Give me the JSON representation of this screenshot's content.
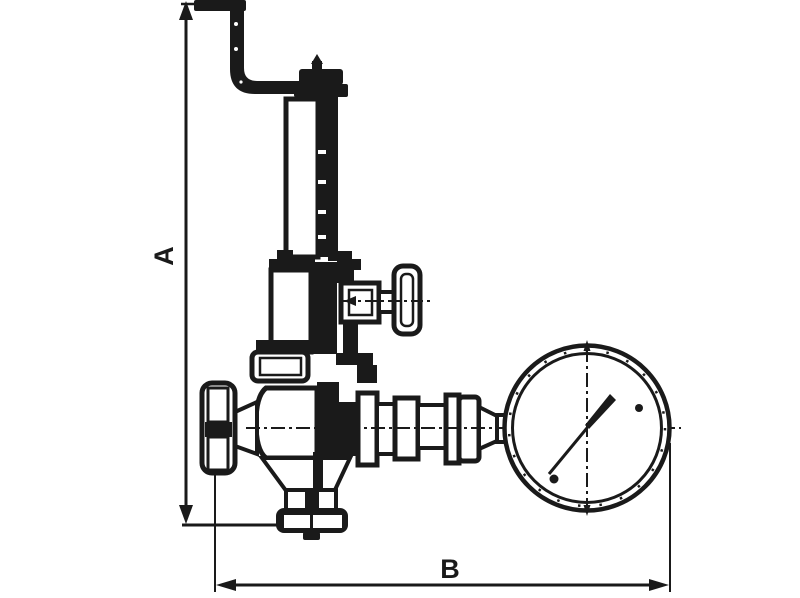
{
  "drawing": {
    "type": "technical-dimensional-drawing",
    "subject": "safety relief valve with test lever and pressure gauge",
    "dimension_labels": {
      "a": "A",
      "b": "B"
    },
    "colors": {
      "line": "#1a1a1a",
      "background": "#ffffff"
    },
    "parts": [
      "test-lever",
      "spring-housing",
      "bonnet",
      "side-adjusting-knob",
      "packing-nut",
      "valve-body",
      "inlet-handwheel",
      "outlet-flange",
      "gauge-connection-fittings",
      "pressure-gauge"
    ]
  }
}
